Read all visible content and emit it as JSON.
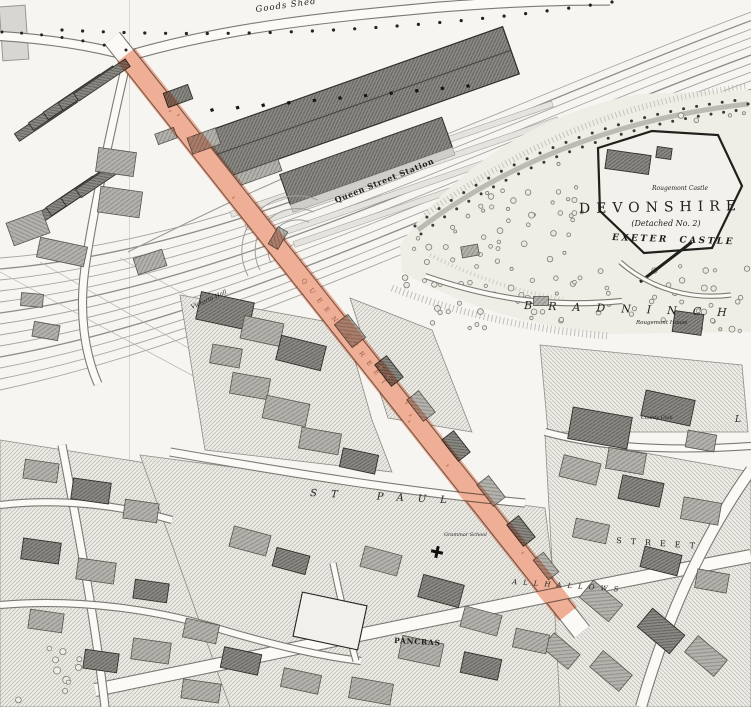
{
  "map": {
    "highlight": {
      "color": "#f2a98f"
    },
    "colors": {
      "paper": "#f6f5f1",
      "ink": "#2b2b2b",
      "hatch": "#c3c2ba"
    },
    "labels": {
      "goods_shed": "Goods Shed",
      "queen_street_station": "Queen Street Station",
      "devonshire": "DEVONSHIRE",
      "detached_no2": "(Detached No. 2)",
      "exeter_castle": "EXETER CASTLE",
      "rougemont_castle": "Rougemont Castle",
      "bradninch": "BRADNINCH",
      "rougemont_house": "Rougemont House",
      "victoria_hall": "Victoria Hall",
      "county_club": "County Club",
      "st_paul": "ST PAUL",
      "allhallows": "ALLHALLOWS",
      "pancras": "PANCRAS",
      "street_fragment": "STREET",
      "grammar_school": "Grammar School",
      "letter_l": "L",
      "queen_street": "QUEEN STREET"
    }
  }
}
